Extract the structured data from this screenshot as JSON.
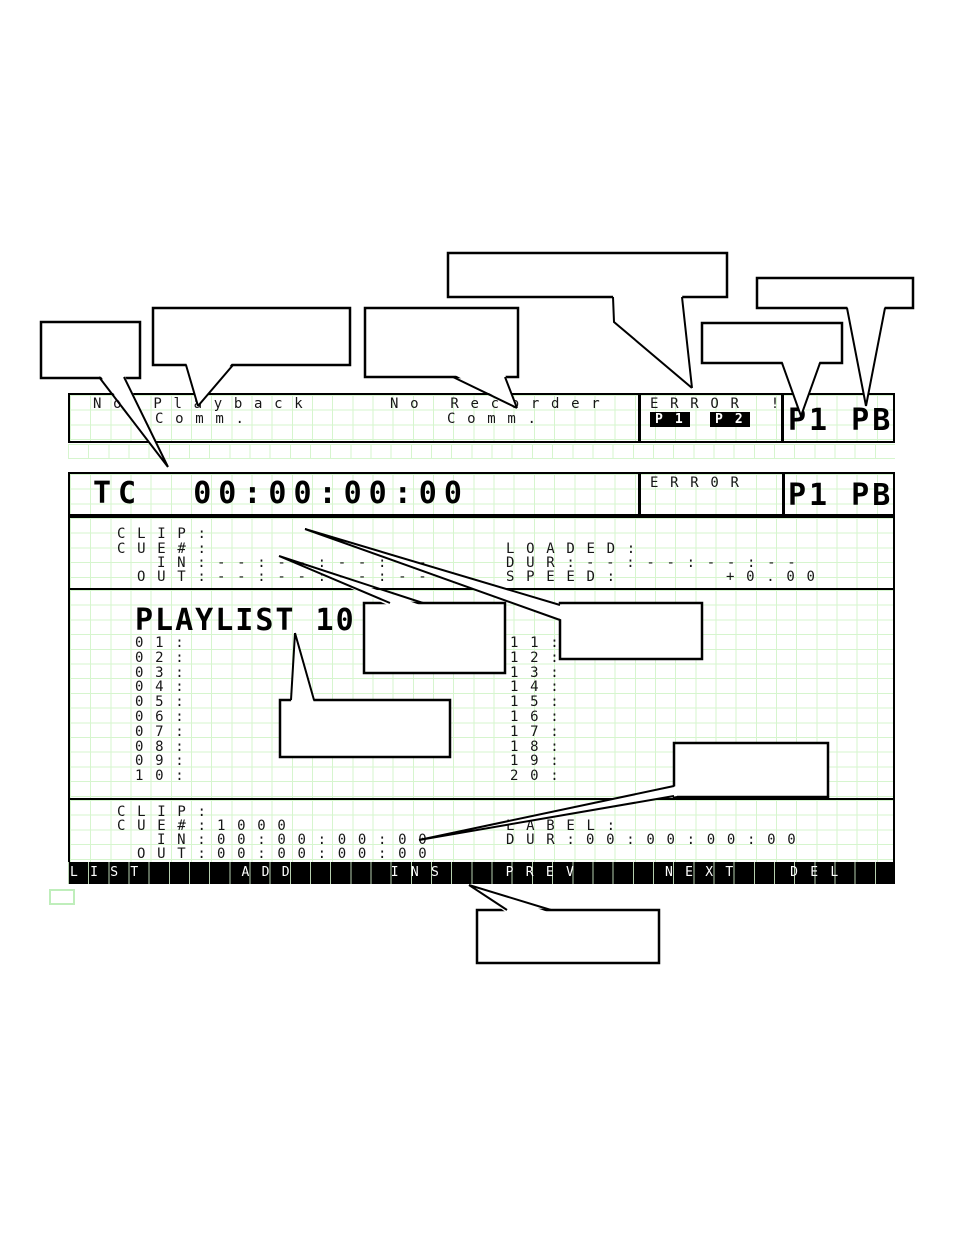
{
  "colors": {
    "grid_line": "#d6f5ce",
    "screen_text": "#161616",
    "menu_bg": "#000000",
    "badge_bg": "#000000"
  },
  "screen_status": {
    "playback_msg_line1": "No Playback",
    "playback_msg_line2": "Comm.",
    "recorder_msg_line1": "No Recorder",
    "recorder_msg_line2": "Comm.",
    "error_text": "ERROR !",
    "p1_badge": "P1",
    "p2_badge": "P2",
    "channel": "P1 PB"
  },
  "screen_main": {
    "timecode": "TC  00:00:00:00",
    "error_text": "ERR0R",
    "channel": "P1 PB"
  },
  "clip_status": {
    "clip_label": "CLIP:",
    "cue_label": "CUE#:",
    "in_label": "IN:",
    "in_value": "--:--:--:--",
    "out_label": "OUT:",
    "out_value": "--:--:--:--",
    "loaded_label": "LOADED:",
    "dur_label": "DUR:",
    "dur_value": "--:--:--:--",
    "speed_label": "SPEED:",
    "speed_value": "+0.00"
  },
  "playlist": {
    "title": "PLAYLIST 10",
    "left_rows": [
      "01:",
      "02:",
      "03:",
      "04:",
      "05:",
      "06:",
      "07:",
      "08:",
      "09:",
      "10:"
    ],
    "right_rows": [
      "11:",
      "12:",
      "13:",
      "14:",
      "15:",
      "16:",
      "17:",
      "18:",
      "19:",
      "20:"
    ]
  },
  "clip_edit": {
    "clip_label": "CLIP:",
    "cue_label": "CUE#:",
    "cue_value": "1000",
    "in_label": "IN:",
    "in_value": "00:00:00:00",
    "out_label": "OUT:",
    "out_value": "00:00:00:00",
    "label_label": "LABEL:",
    "dur_label": "DUR:",
    "dur_value": "00:00:00:00"
  },
  "menu": {
    "items": [
      {
        "label": "LIST",
        "cell": 0
      },
      {
        "label": "ADD",
        "cell": 8.5
      },
      {
        "label": "INS",
        "cell": 15.9
      },
      {
        "label": "PREV",
        "cell": 21.6
      },
      {
        "label": "NEXT",
        "cell": 29.5
      },
      {
        "label": "DEL",
        "cell": 35.7
      }
    ]
  }
}
